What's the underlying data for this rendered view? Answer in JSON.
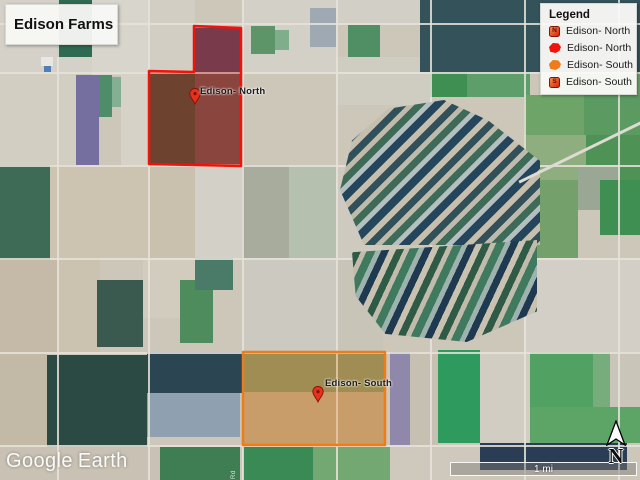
{
  "title_card": {
    "label": "Edison Farms"
  },
  "legend": {
    "title": "Legend",
    "items": [
      {
        "icon": "placemark-north-icon",
        "badge": "N",
        "label": "Edison- North"
      },
      {
        "icon": "polygon-red-icon",
        "badge": "",
        "label": "Edison- North"
      },
      {
        "icon": "polygon-orange-icon",
        "badge": "",
        "label": "Edison- South"
      },
      {
        "icon": "placemark-south-icon",
        "badge": "S",
        "label": "Edison- South"
      }
    ]
  },
  "map": {
    "labels": [
      {
        "text": "Edison- North",
        "x": 200,
        "y": 86
      },
      {
        "text": "Edison- South",
        "x": 325,
        "y": 378
      }
    ],
    "polygons": [
      {
        "name": "edison-north-polygon",
        "stroke": "#f2120a",
        "fill": "rgba(195,25,15,0.32)",
        "points": "194,26 241,28 241,166 149,164 149,71 194,72"
      },
      {
        "name": "edison-south-polygon",
        "stroke": "#ee7c17",
        "fill": "rgba(238,140,45,0.30)",
        "points": "243,352 385,352 385,445 243,445"
      }
    ],
    "pins": [
      {
        "x": 195,
        "y": 104
      },
      {
        "x": 318,
        "y": 402
      }
    ],
    "road_label": "Rd"
  },
  "footer": {
    "watermark_google": "Google",
    "watermark_earth": "Earth",
    "scale_label": "1 mi",
    "north_label": "N"
  },
  "colors": {
    "north_accent": "#f2120a",
    "south_accent": "#ee7c17",
    "pin_fill": "#e8301c",
    "pin_stroke": "#7e130a"
  },
  "satellite_mosaic": {
    "base": "#cdc7ba",
    "h_roads": [
      23,
      72,
      165,
      258,
      352,
      445
    ],
    "v_roads": [
      57,
      148,
      242,
      336,
      430,
      524,
      618
    ],
    "tiles": [
      [
        0,
        0,
        92,
        72,
        "#d5d1c9"
      ],
      [
        57,
        0,
        35,
        57,
        "#2f6b52"
      ],
      [
        92,
        0,
        56,
        75,
        "#d8d5cd"
      ],
      [
        148,
        0,
        47,
        72,
        "#d2cec4"
      ],
      [
        41,
        57,
        12,
        9,
        "#e9e7e3"
      ],
      [
        44,
        66,
        7,
        7,
        "#4f80b0"
      ],
      [
        0,
        72,
        76,
        93,
        "#d3cec2"
      ],
      [
        76,
        75,
        23,
        90,
        "#756fa0"
      ],
      [
        99,
        75,
        13,
        42,
        "#4f8c69"
      ],
      [
        112,
        77,
        9,
        30,
        "#83b092"
      ],
      [
        121,
        72,
        27,
        93,
        "#d6d2c8"
      ],
      [
        195,
        28,
        46,
        44,
        "#564a68"
      ],
      [
        150,
        73,
        45,
        91,
        "#45563e"
      ],
      [
        195,
        72,
        46,
        92,
        "#6e5a55"
      ],
      [
        242,
        0,
        94,
        72,
        "#d3d0c8"
      ],
      [
        251,
        26,
        24,
        28,
        "#5d9468"
      ],
      [
        275,
        30,
        14,
        20,
        "#7fae8a"
      ],
      [
        310,
        8,
        26,
        39,
        "#9fa9b4"
      ],
      [
        336,
        0,
        94,
        25,
        "#d2cfc7"
      ],
      [
        348,
        25,
        32,
        32,
        "#4f8f63"
      ],
      [
        336,
        57,
        94,
        48,
        "#cfccc2"
      ],
      [
        420,
        0,
        220,
        72,
        "#33525a"
      ],
      [
        430,
        72,
        37,
        25,
        "#3f8f52"
      ],
      [
        467,
        72,
        63,
        25,
        "#5e9e6a"
      ],
      [
        560,
        72,
        80,
        23,
        "#6ca368"
      ],
      [
        524,
        95,
        60,
        40,
        "#6fa468"
      ],
      [
        584,
        95,
        56,
        40,
        "#5b9a60"
      ],
      [
        524,
        135,
        62,
        45,
        "#8fae7f"
      ],
      [
        586,
        135,
        54,
        45,
        "#4e9256"
      ],
      [
        578,
        165,
        42,
        45,
        "#9aa795"
      ],
      [
        524,
        180,
        54,
        78,
        "#73a06b"
      ],
      [
        600,
        180,
        40,
        55,
        "#3f8f52"
      ],
      [
        524,
        258,
        116,
        94,
        "#d3cfc6"
      ],
      [
        0,
        165,
        50,
        95,
        "#3d6b55"
      ],
      [
        50,
        165,
        98,
        93,
        "#ccc3b1"
      ],
      [
        148,
        165,
        47,
        93,
        "#c9c0ae"
      ],
      [
        195,
        165,
        47,
        93,
        "#d3d0c8"
      ],
      [
        242,
        165,
        47,
        93,
        "#a8ac9d"
      ],
      [
        289,
        165,
        47,
        93,
        "#b6c0af"
      ],
      [
        336,
        165,
        47,
        93,
        "#cecabf"
      ],
      [
        0,
        260,
        57,
        92,
        "#c5baa8"
      ],
      [
        57,
        258,
        43,
        94,
        "#cbc2b0"
      ],
      [
        97,
        280,
        46,
        67,
        "#3a5a50"
      ],
      [
        143,
        258,
        52,
        60,
        "#d1ccbe"
      ],
      [
        180,
        280,
        33,
        63,
        "#4e8c5e"
      ],
      [
        195,
        258,
        38,
        32,
        "#4a7a68"
      ],
      [
        242,
        258,
        94,
        94,
        "#ccc9c1"
      ],
      [
        336,
        258,
        47,
        94,
        "#c9c4b8"
      ],
      [
        0,
        352,
        47,
        128,
        "#c3b9a7"
      ],
      [
        47,
        355,
        100,
        92,
        "#2c4a44"
      ],
      [
        147,
        352,
        95,
        41,
        "#2b4552"
      ],
      [
        147,
        393,
        93,
        44,
        "#8fa0b0"
      ],
      [
        0,
        447,
        160,
        33,
        "#c9c2b4"
      ],
      [
        160,
        447,
        80,
        33,
        "#3e7e52"
      ],
      [
        243,
        352,
        142,
        40,
        "#7e8f63"
      ],
      [
        243,
        392,
        142,
        53,
        "#b9a584"
      ],
      [
        243,
        447,
        70,
        33,
        "#3a8a55"
      ],
      [
        313,
        447,
        77,
        33,
        "#74a873"
      ],
      [
        390,
        352,
        20,
        93,
        "#9088aa"
      ],
      [
        410,
        352,
        28,
        93,
        "#c6c0b3"
      ],
      [
        438,
        350,
        42,
        93,
        "#2f9a5e"
      ],
      [
        480,
        352,
        50,
        91,
        "#d1cdc3"
      ],
      [
        530,
        352,
        63,
        55,
        "#51a163"
      ],
      [
        593,
        352,
        47,
        55,
        "#77ad7c"
      ],
      [
        610,
        352,
        30,
        55,
        "#cac5b9"
      ],
      [
        530,
        407,
        110,
        36,
        "#5ca566"
      ],
      [
        480,
        443,
        147,
        27,
        "#2b3d55"
      ],
      [
        390,
        445,
        90,
        35,
        "#cfc9bd"
      ]
    ]
  }
}
